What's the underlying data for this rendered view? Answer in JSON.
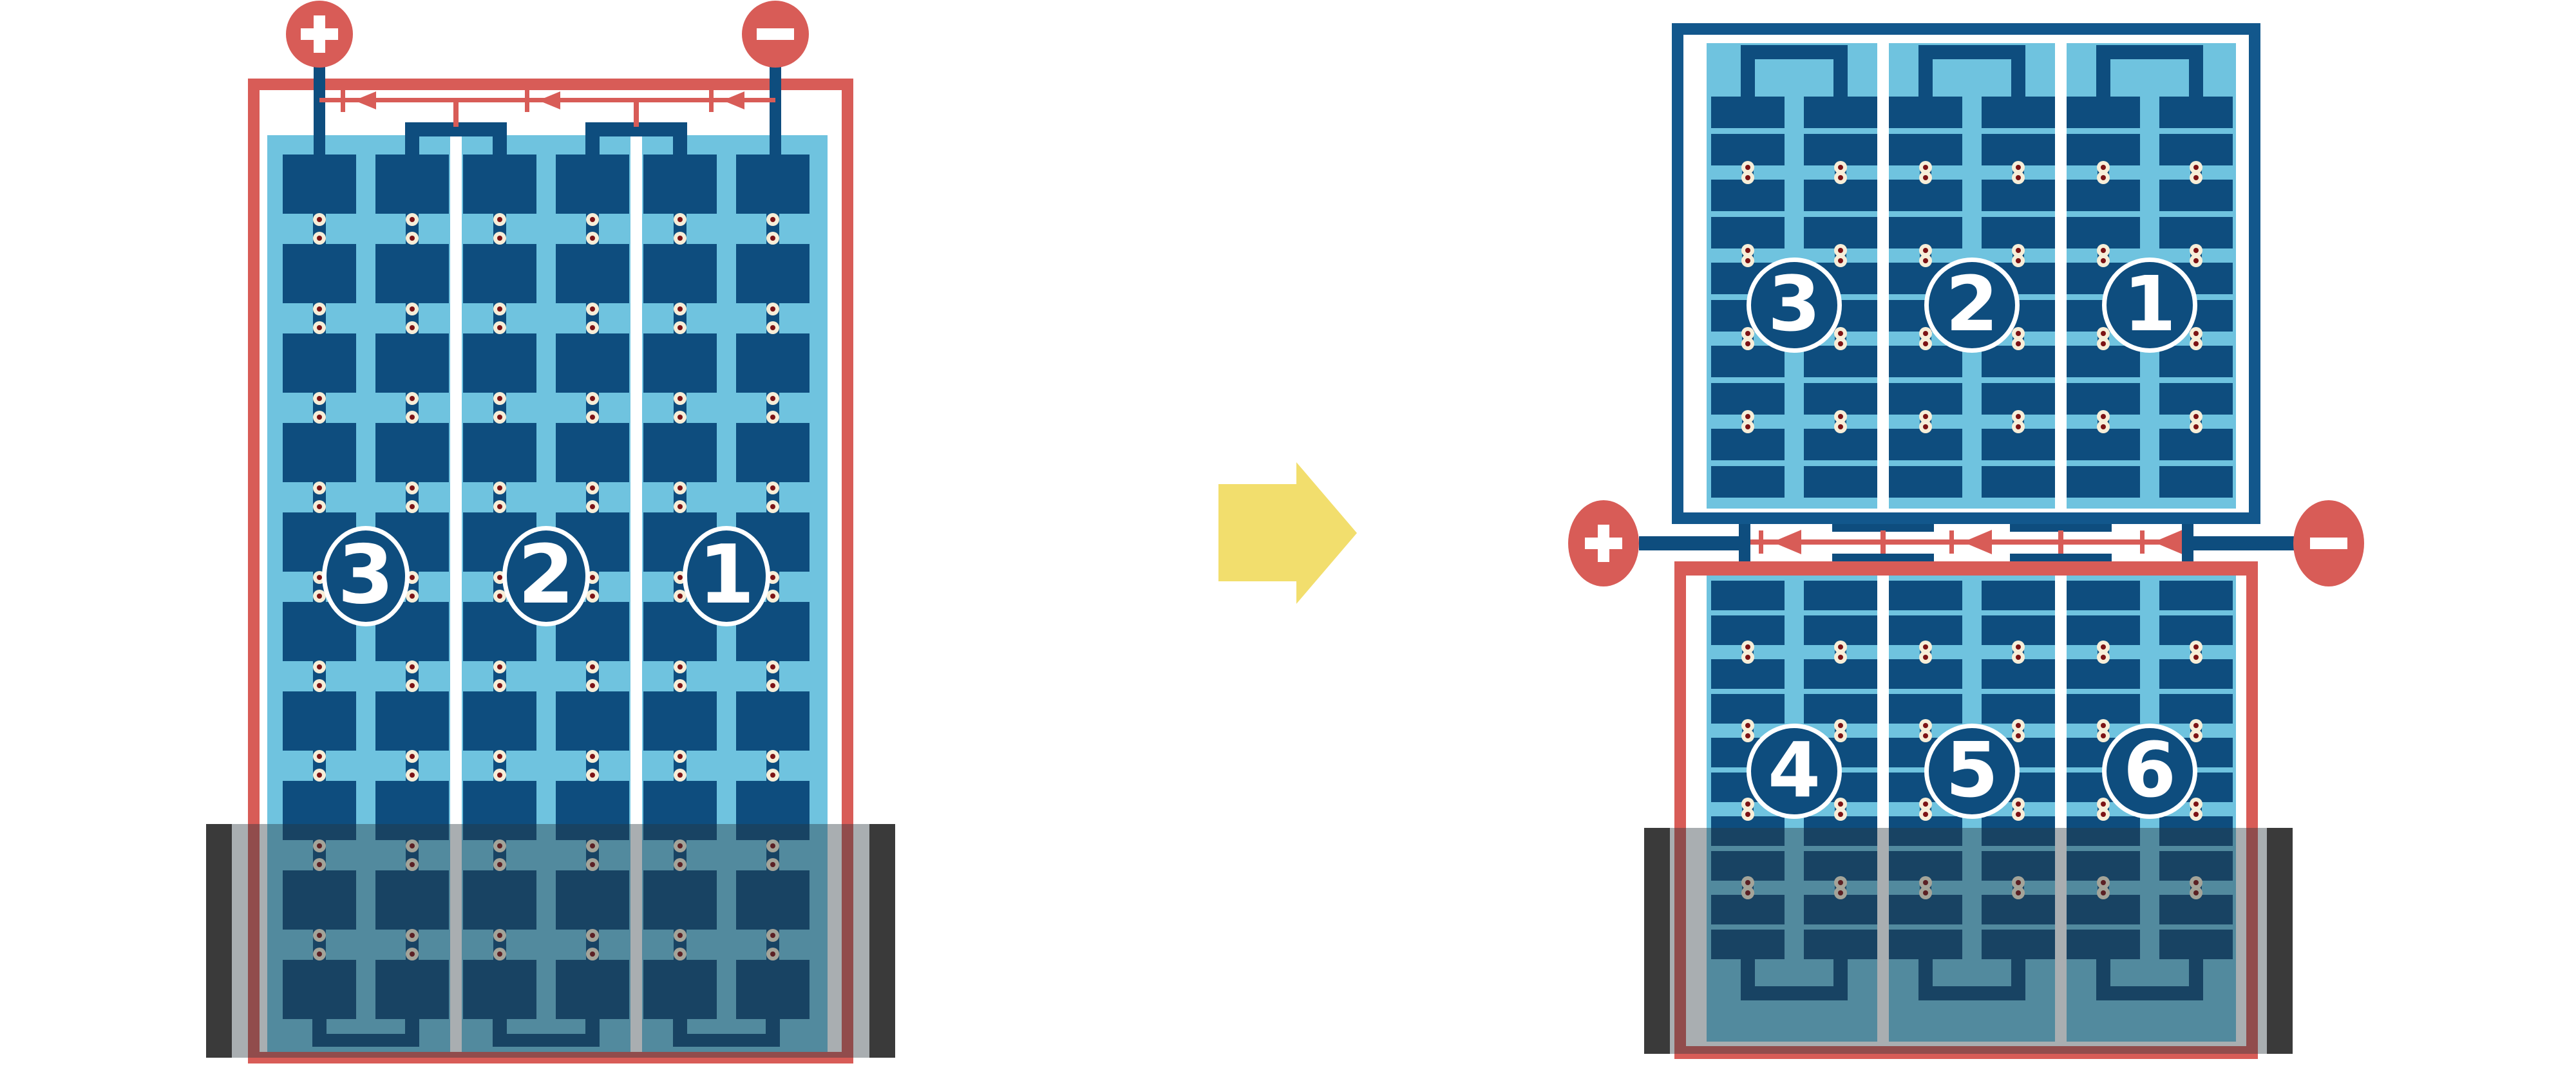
{
  "diagram": {
    "description": "Solar module bypass-diode wiring: standard full-cell module versus half-cut-cell module under bottom-edge shading",
    "left_module": {
      "type": "full-cell module",
      "rows_of_cells": 10,
      "cell_columns": 6,
      "strings": [
        {
          "label": "3"
        },
        {
          "label": "2"
        },
        {
          "label": "1"
        }
      ],
      "bypass_diode_count": 3,
      "terminals": {
        "positive_sign": "+",
        "negative_sign": "−"
      },
      "shade_position": "bottom"
    },
    "right_module": {
      "type": "half-cut-cell module",
      "rows_of_half_cells_per_half": 10,
      "cell_columns": 6,
      "top_half_strings": [
        {
          "label": "3"
        },
        {
          "label": "2"
        },
        {
          "label": "1"
        }
      ],
      "bottom_half_strings": [
        {
          "label": "4"
        },
        {
          "label": "5"
        },
        {
          "label": "6"
        }
      ],
      "bypass_diode_count": 3,
      "terminals": {
        "positive_sign": "+",
        "negative_sign": "−"
      },
      "shade_position": "bottom"
    },
    "transition_arrow": {
      "direction": "right"
    }
  },
  "colors": {
    "background": "#FFFFFF",
    "red": "#D85C57",
    "navy": "#0E4D7E",
    "frame_blue": "#12578C",
    "light_blue": "#6FC3DF",
    "solder_cream": "#F7EED8",
    "solder_dot": "#7D1315",
    "shade": "rgba(40,52,60,0.40)",
    "shade_cap": "#3A3A3A",
    "arrow_yellow": "#F2DE6D",
    "white": "#FFFFFF"
  }
}
